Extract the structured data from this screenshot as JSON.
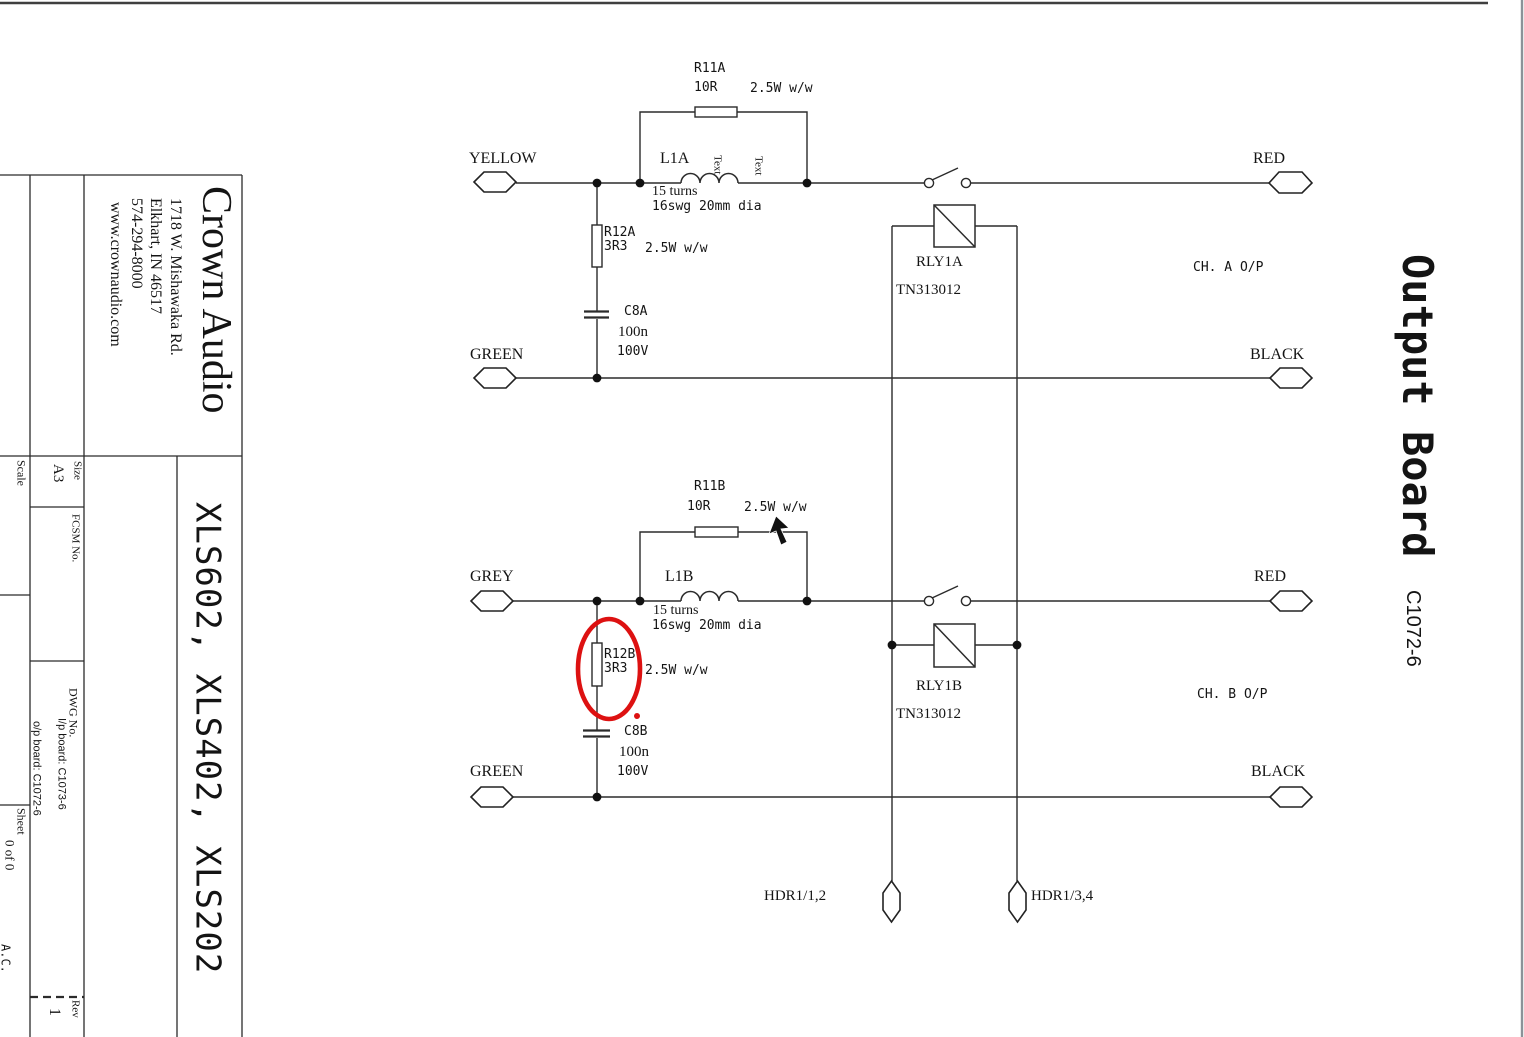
{
  "title_block": {
    "company": "Crown Audio",
    "address1": "1718 W. Mishawaka Rd.",
    "address2": "Elkhart, IN 46517",
    "phone": "574-294-8000",
    "website": "www.crownaudio.com",
    "size_label": "Size",
    "size_value": "A3",
    "scale_label": "Scale",
    "fcsm_label": "FCSM No.",
    "dwg_label": "DWG No.",
    "dwg_ip_board": "I/p board: C1073-6",
    "dwg_op_board": "o/p board: C1072-6",
    "sheet_label": "Sheet",
    "sheet_value": "0 of 0",
    "initials": "A.C.",
    "rev_label": "Rev",
    "rev_value": "1",
    "models": "XLS602, XLS402, XLS202"
  },
  "drawing_title": {
    "title": "Output Board",
    "number": "C1072-6"
  },
  "channel_a": {
    "input_top": "YELLOW",
    "input_bottom": "GREEN",
    "output_top": "RED",
    "output_bottom": "BLACK",
    "r11_ref": "R11A",
    "r11_value": "10R",
    "r11_rating": "2.5W w/w",
    "l1_ref": "L1A",
    "l1_turns": "15 turns",
    "l1_wire": "16swg 20mm dia",
    "l1_text1": "Text",
    "l1_text2": "Text",
    "r12_ref": "R12A",
    "r12_value": "3R3",
    "r12_rating": "2.5W w/w",
    "c8_ref": "C8A",
    "c8_value": "100n",
    "c8_voltage": "100V",
    "relay_ref": "RLY1A",
    "relay_part": "TN313012",
    "output_label": "CH. A O/P"
  },
  "channel_b": {
    "input_top": "GREY",
    "input_bottom": "GREEN",
    "output_top": "RED",
    "output_bottom": "BLACK",
    "r11_ref": "R11B",
    "r11_value": "10R",
    "r11_rating": "2.5W w/w",
    "l1_ref": "L1B",
    "l1_turns": "15 turns",
    "l1_wire": "16swg 20mm dia",
    "r12_ref": "R12B",
    "r12_value": "3R3",
    "r12_rating": "2.5W w/w",
    "c8_ref": "C8B",
    "c8_value": "100n",
    "c8_voltage": "100V",
    "relay_ref": "RLY1B",
    "relay_part": "TN313012",
    "output_label": "CH. B O/P"
  },
  "headers": {
    "left": "HDR1/1,2",
    "right": "HDR1/3,4"
  },
  "annotation": {
    "color": "#dd1111"
  }
}
